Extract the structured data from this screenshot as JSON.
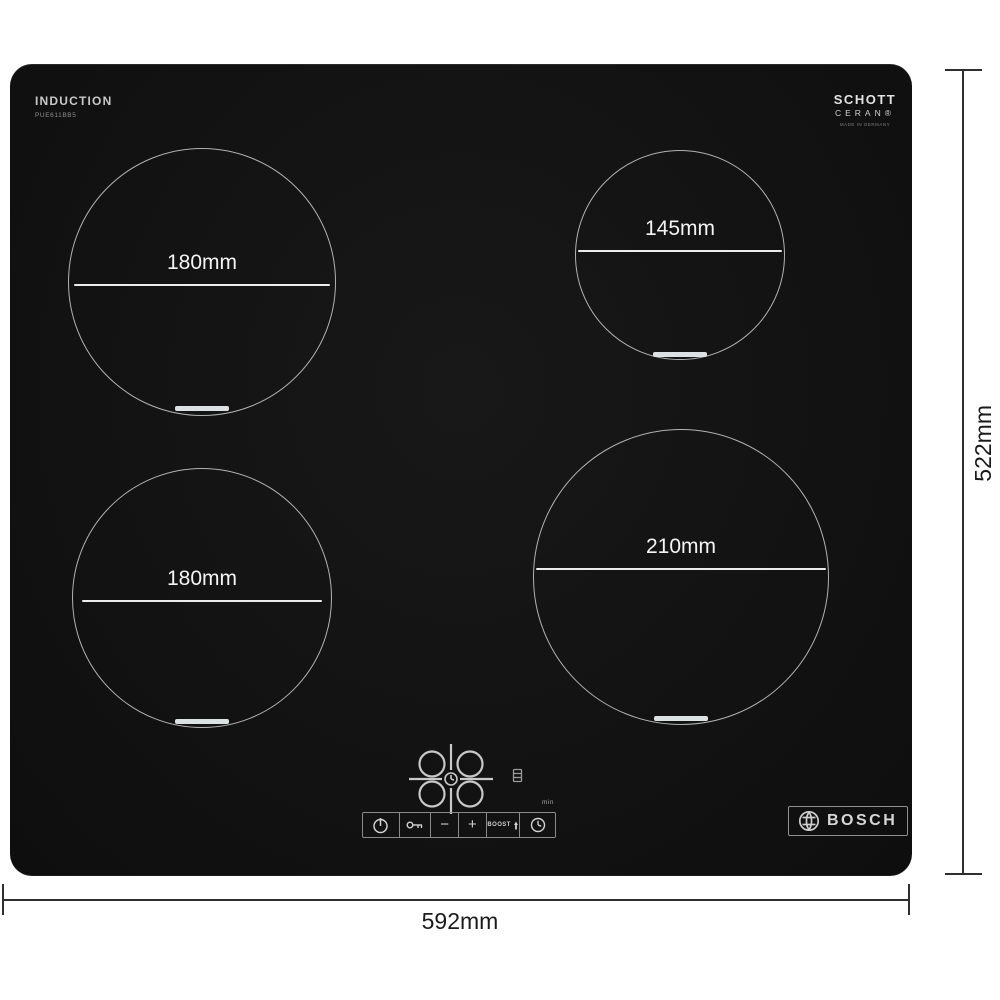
{
  "product": {
    "type_label": "INDUCTION",
    "model_number": "PUE611BB5",
    "brand_name": "BOSCH",
    "glass_brand_line1": "SCHOTT",
    "glass_brand_line2": "CERAN®",
    "glass_brand_line3": "MADE IN GERMANY"
  },
  "zones": [
    {
      "position": "rear-left",
      "diameter": "180mm"
    },
    {
      "position": "rear-right",
      "diameter": "145mm"
    },
    {
      "position": "front-left",
      "diameter": "180mm"
    },
    {
      "position": "front-right",
      "diameter": "210mm"
    }
  ],
  "controls": {
    "minus_label": "−",
    "plus_label": "+",
    "boost_label": "BOOST",
    "timer_unit_label": "min"
  },
  "dimensions": {
    "width_label": "592mm",
    "depth_label": "522mm"
  },
  "colors": {
    "hob_surface": "#141414",
    "zone_ring": "#b2b2b2",
    "zone_text": "#f4f4f4",
    "dimension_line": "#2f2f2f",
    "dimension_text": "#1b1b1b"
  }
}
